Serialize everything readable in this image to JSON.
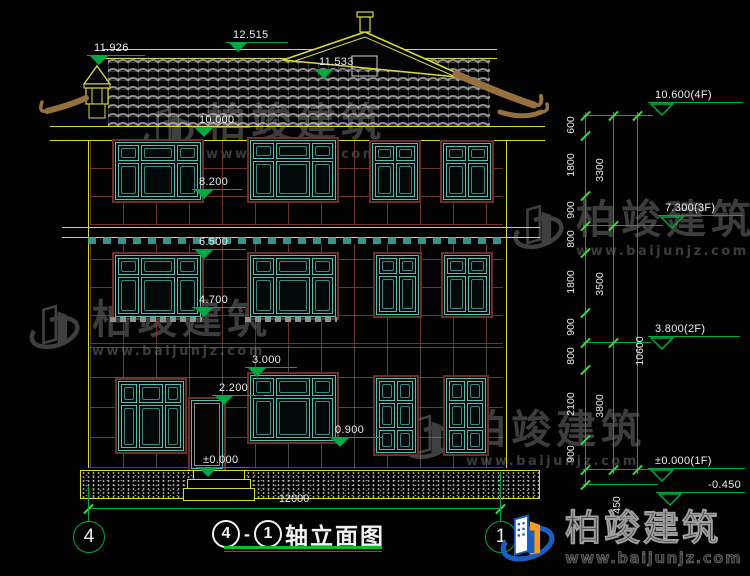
{
  "drawing": {
    "title": {
      "axis_start": "4",
      "separator": "-",
      "axis_end": "1",
      "name": "轴立面图"
    },
    "bottom_width_dim": "12000",
    "axis_bubble_left": "4",
    "axis_bubble_right": "1"
  },
  "elevation_marks": {
    "ridge": "12.515",
    "left_finial": "11.926",
    "gable": "11.533",
    "eave": "10.000",
    "f3_sill": "8.200",
    "f2_head": "6.500",
    "f2_sill": "4.700",
    "f1_head": "3.000",
    "door_head": "2.200",
    "f1_sill": "0.900",
    "ground": "±0.000"
  },
  "right_marks": {
    "l4": "10.600(4F)",
    "l3": "7.300(3F)",
    "l2": "3.800(2F)",
    "l1": "±0.000(1F)",
    "lb": "-0.450"
  },
  "chain": {
    "segments": [
      "600",
      "1800",
      "900",
      "800",
      "1800",
      "900",
      "800",
      "2100",
      "900"
    ],
    "base": "450",
    "floors": [
      "3300",
      "3500",
      "3800"
    ],
    "total": "10600"
  },
  "watermark": {
    "brand": "柏竣建筑",
    "site": "www.baijunjz.com"
  },
  "colors": {
    "background": "#020202",
    "outline_yellow": "#d8d83c",
    "window_teal": "#4ec2b6",
    "frame_maroon": "#6e2f26",
    "dim_green": "#00a843",
    "tick_green": "#35e035",
    "text_white": "#ececec",
    "watermark_gray": "#484848",
    "logo_blue": "#1a5fc0",
    "logo_orange": "#f49c1c"
  }
}
